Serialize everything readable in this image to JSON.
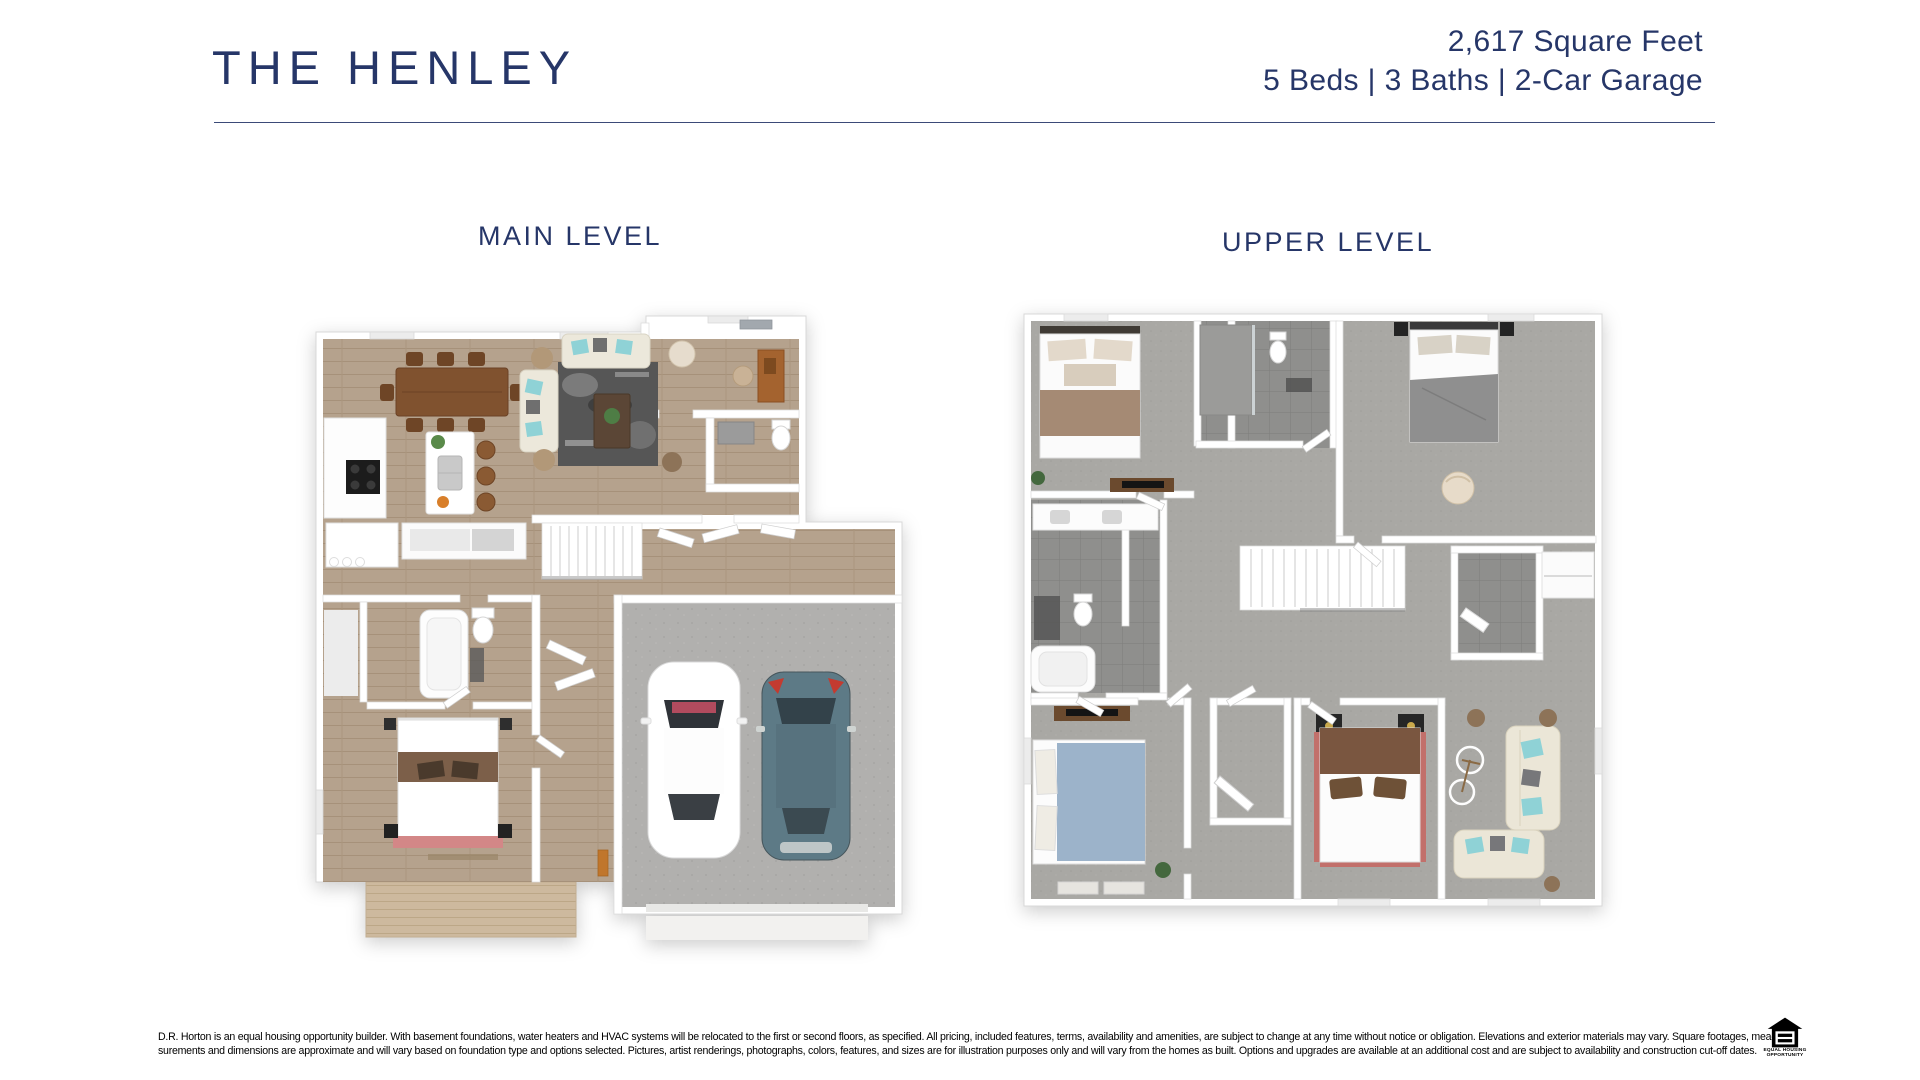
{
  "header": {
    "title": "THE HENLEY",
    "square_feet": "2,617 Square Feet",
    "specs": "5 Beds | 3 Baths | 2-Car Garage"
  },
  "plans": {
    "main": {
      "label": "MAIN LEVEL"
    },
    "upper": {
      "label": "UPPER LEVEL"
    }
  },
  "floor_plan_features": {
    "main_level": [
      "dining-area",
      "living-room",
      "kitchen-with-island",
      "den",
      "half-bath",
      "staircase",
      "bedroom",
      "full-bath",
      "mudroom",
      "2-car-garage",
      "deck"
    ],
    "upper_level": [
      "bedroom-brown",
      "primary-bedroom",
      "bedroom-blue",
      "bedroom-red",
      "primary-bathroom",
      "hall-bathroom",
      "laundry",
      "loft",
      "staircase",
      "walk-in-closets"
    ]
  },
  "footer": {
    "disclaimer_line1": "D.R. Horton is an equal housing opportunity builder. With basement foundations, water heaters and HVAC systems will be relocated to the first or second floors, as specified. All pricing, included features, terms, availability and amenities, are subject to change at any time without notice or obligation. Elevations and exterior materials may vary. Square footages, mea-",
    "disclaimer_line2": "surements and dimensions are approximate and will vary based on foundation type and options selected. Pictures, artist renderings, photographs, colors, features, and sizes are for illustration purposes only and will vary from the homes as built. Options and upgrades are available at an additional cost and are subject to availability and construction cut-off dates.",
    "eho_line1": "EQUAL HOUSING",
    "eho_line2": "OPPORTUNITY"
  },
  "colors": {
    "navy": "#263668",
    "wood_floor": "#b5a28d",
    "deck_wood": "#cdb99e",
    "carpet": "#a9a8a4",
    "tile": "#8f8f8d",
    "concrete": "#b1b0ae",
    "accent_teal_pillow": "#8fd2d6",
    "car_teal": "#5d7a86"
  }
}
